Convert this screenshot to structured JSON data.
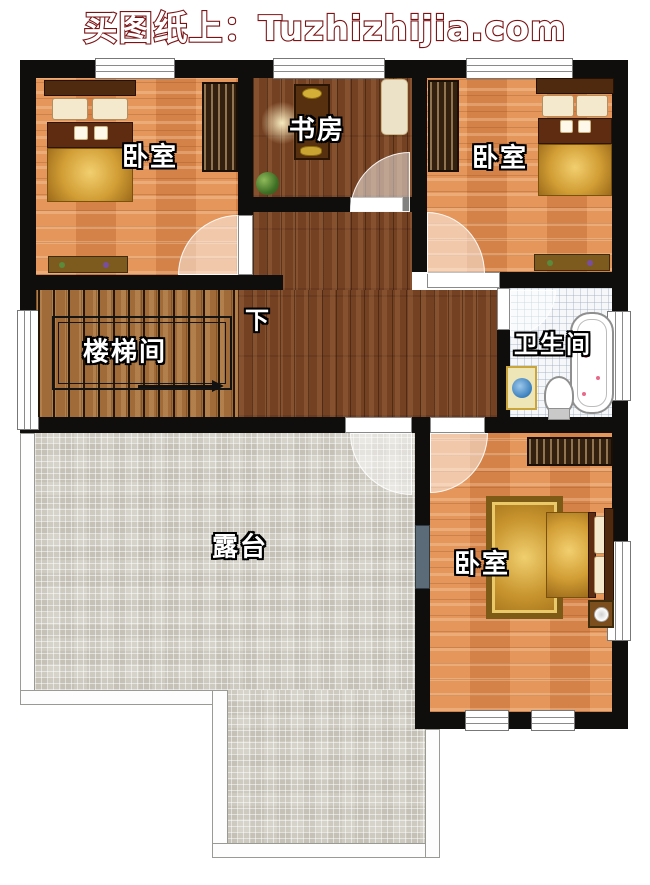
{
  "header": {
    "title": "买图纸上：Tuzhizhijia.com",
    "brand_color": "#7b1315"
  },
  "plan": {
    "rooms": {
      "bedroom_top_left": {
        "label": "卧室"
      },
      "study": {
        "label": "书房"
      },
      "bedroom_top_right": {
        "label": "卧室"
      },
      "stairwell": {
        "label": "楼梯间",
        "stair_direction": "下"
      },
      "bathroom": {
        "label": "卫生间"
      },
      "terrace": {
        "label": "露台"
      },
      "bedroom_bottom_right": {
        "label": "卧室"
      }
    },
    "colors": {
      "wall": "#0f0e0c",
      "bedroom_floor": "#df8c50",
      "hallway_floor": "#754123",
      "stair_floor": "#a06b38",
      "terrace_tile": "#d6d3ca",
      "bathroom_tile": "#f6f7f9",
      "label_text": "#ffffff"
    }
  }
}
